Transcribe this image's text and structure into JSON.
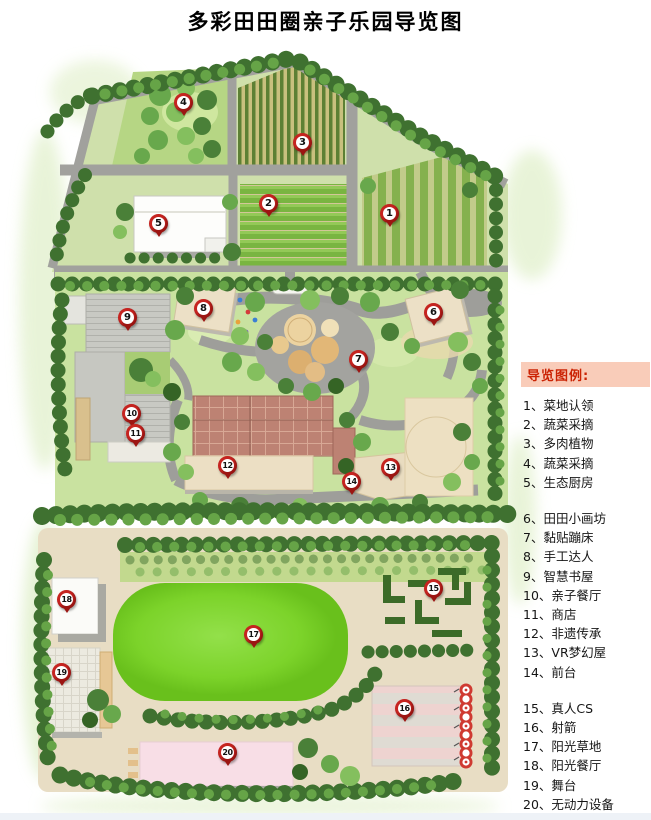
{
  "title": "多彩田田圈亲子乐园导览图",
  "legend": {
    "header": "导览图例:",
    "separator": "、",
    "groups": [
      {
        "items": [
          {
            "num": "1",
            "label": "菜地认领"
          },
          {
            "num": "2",
            "label": "蔬菜采摘"
          },
          {
            "num": "3",
            "label": "多肉植物"
          },
          {
            "num": "4",
            "label": "蔬菜采摘"
          },
          {
            "num": "5",
            "label": "生态厨房"
          }
        ]
      },
      {
        "items": [
          {
            "num": "6",
            "label": "田田小画坊"
          },
          {
            "num": "7",
            "label": "黏贴蹦床"
          },
          {
            "num": "8",
            "label": "手工达人"
          },
          {
            "num": "9",
            "label": "智慧书屋"
          },
          {
            "num": "10",
            "label": "亲子餐厅"
          },
          {
            "num": "11",
            "label": "商店"
          },
          {
            "num": "12",
            "label": "非遗传承"
          },
          {
            "num": "13",
            "label": "VR梦幻屋"
          },
          {
            "num": "14",
            "label": "前台"
          }
        ]
      },
      {
        "items": [
          {
            "num": "15",
            "label": "真人CS"
          },
          {
            "num": "16",
            "label": "射箭"
          },
          {
            "num": "17",
            "label": "阳光草地"
          },
          {
            "num": "18",
            "label": "阳光餐厅"
          },
          {
            "num": "19",
            "label": "舞台"
          },
          {
            "num": "20",
            "label": "无动力设备"
          }
        ]
      }
    ]
  },
  "markers": [
    {
      "num": "1",
      "x": 390,
      "y": 214
    },
    {
      "num": "2",
      "x": 269,
      "y": 204
    },
    {
      "num": "3",
      "x": 303,
      "y": 143
    },
    {
      "num": "4",
      "x": 184,
      "y": 103
    },
    {
      "num": "5",
      "x": 159,
      "y": 224
    },
    {
      "num": "6",
      "x": 434,
      "y": 313
    },
    {
      "num": "7",
      "x": 359,
      "y": 360
    },
    {
      "num": "8",
      "x": 204,
      "y": 309
    },
    {
      "num": "9",
      "x": 128,
      "y": 318
    },
    {
      "num": "10",
      "x": 132,
      "y": 414
    },
    {
      "num": "11",
      "x": 136,
      "y": 434
    },
    {
      "num": "12",
      "x": 228,
      "y": 466
    },
    {
      "num": "13",
      "x": 391,
      "y": 468
    },
    {
      "num": "14",
      "x": 352,
      "y": 482
    },
    {
      "num": "15",
      "x": 434,
      "y": 589
    },
    {
      "num": "16",
      "x": 405,
      "y": 709
    },
    {
      "num": "17",
      "x": 254,
      "y": 635
    },
    {
      "num": "18",
      "x": 67,
      "y": 600
    },
    {
      "num": "19",
      "x": 62,
      "y": 673
    },
    {
      "num": "20",
      "x": 228,
      "y": 753
    }
  ],
  "colors": {
    "marker_red": "#c62420",
    "legend_header_bg": "#f9ccb9",
    "legend_header_text": "#cb2304",
    "lawn_green": "#7cd32a",
    "road_gray": "#a1a19d",
    "sand": "#e8ddc4"
  }
}
